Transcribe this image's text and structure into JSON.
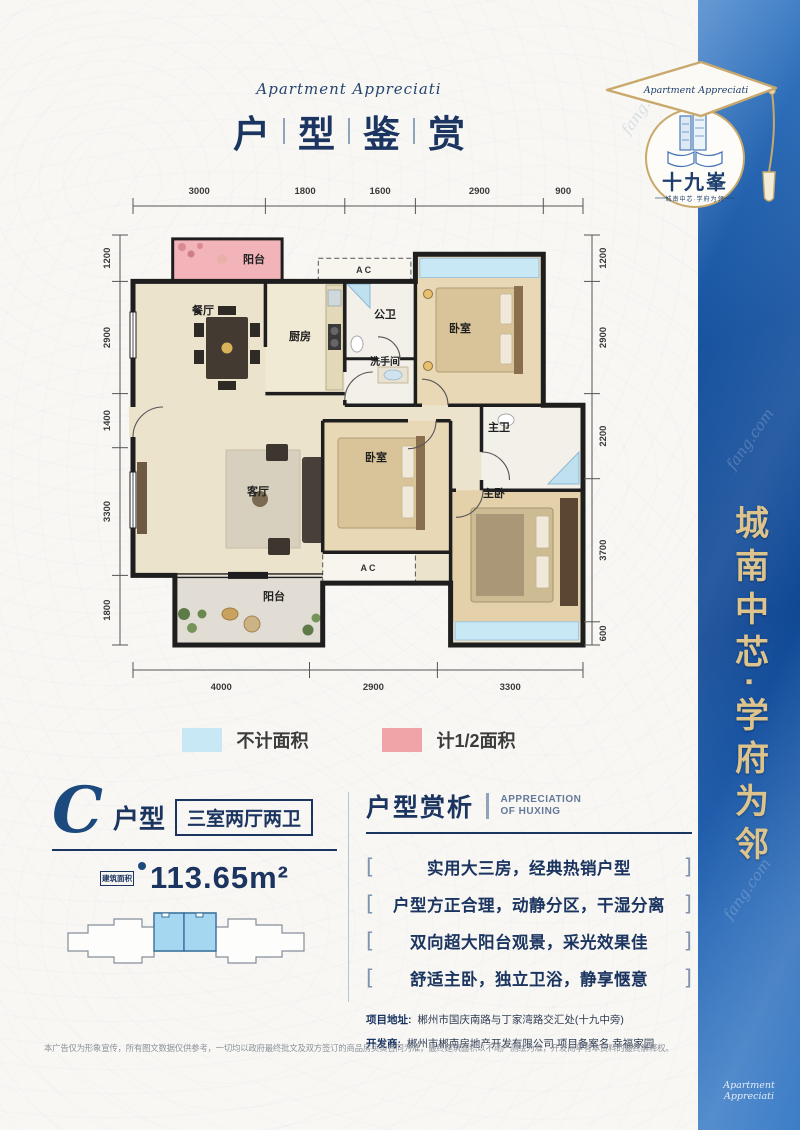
{
  "watermark": "fang.com",
  "header": {
    "subtitle_en": "Apartment Appreciati",
    "title_chars": [
      "户",
      "型",
      "鉴",
      "赏"
    ]
  },
  "logo": {
    "cap_text": "Apartment Appreciati",
    "name": "十九峯",
    "tagline": "城南中芯·学府为邻"
  },
  "banner": {
    "slogan": "城南中芯·学府为邻",
    "footer_en": "Apartment Appreciati"
  },
  "plan": {
    "dims_top": [
      "3000",
      "1800",
      "1600",
      "2900",
      "900"
    ],
    "dims_bottom": [
      "4000",
      "2900",
      "3300"
    ],
    "dims_left": [
      "1200",
      "2900",
      "1400",
      "3300",
      "1800"
    ],
    "dims_right": [
      "1200",
      "2900",
      "2200",
      "3700",
      "600"
    ],
    "rooms": {
      "balcony_top": "阳台",
      "dining": "餐厅",
      "kitchen": "厨房",
      "guest_bath": "公卫",
      "washroom": "洗手间",
      "bedroom_top": "卧室",
      "master_bath": "主卫",
      "bedroom_mid": "卧室",
      "living": "客厅",
      "master_bedroom": "主卧",
      "balcony_bottom": "阳台",
      "ac": "AC"
    }
  },
  "legend": [
    {
      "label": "不计面积",
      "color": "#c9e8f6"
    },
    {
      "label": "计1/2面积",
      "color": "#f0a4a7"
    }
  ],
  "unit": {
    "letter": "C",
    "type_label": "户型",
    "layout_badge": "三室两厅两卫",
    "area_label": "建筑面积",
    "area_value": "113.65m²"
  },
  "analysis": {
    "title": "户型赏析",
    "subtitle_line1": "APPRECIATION",
    "subtitle_line2": "OF HUXING",
    "bracket_left": "[",
    "bracket_right": "]",
    "points": [
      "实用大三房，经典热销户型",
      "户型方正合理，动静分区，干湿分离",
      "双向超大阳台观景，采光效果佳",
      "舒适主卧，独立卫浴，静享惬意"
    ]
  },
  "project": {
    "address_label": "项目地址:",
    "address": "郴州市国庆南路与丁家湾路交汇处(十九中旁)",
    "developer_label": "开发商:",
    "developer": "郴州市郴南房地产开发有限公司 项目备案名 幸福家园"
  },
  "disclaimer": "本广告仅为形象宣传，所有图文数据仅供参考，一切均以政府最终批文及双方签订的商品房买卖合同为准，最终建筑面积以不动产测绘为准，开发商享有本资料的最终解释权。",
  "colors": {
    "navy": "#1b3560",
    "banner_blue": "#14509e",
    "gold": "#ddc48d",
    "legend_blue": "#c9e8f6",
    "legend_pink": "#f0a4a7"
  }
}
